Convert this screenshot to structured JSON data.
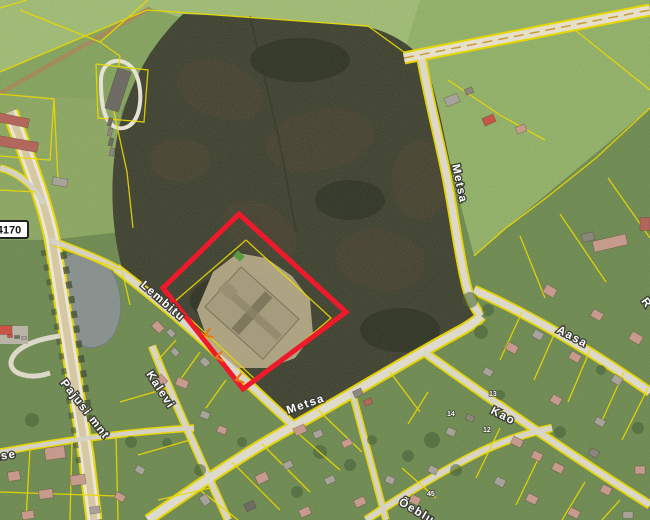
{
  "map": {
    "parcel_color": "#ecd800",
    "highlight": {
      "color": "#ee1a2b"
    },
    "road_badge": {
      "text": "4170"
    },
    "street_labels": [
      {
        "id": "lembitu",
        "text": "Lembitu"
      },
      {
        "id": "kalevi",
        "text": "Kalevi"
      },
      {
        "id": "metsa-south",
        "text": "Metsa"
      },
      {
        "id": "metsa-north",
        "text": "Metsa"
      },
      {
        "id": "aasa",
        "text": "Aasa"
      },
      {
        "id": "pajusi-mnt",
        "text": "Pajusi mnt"
      },
      {
        "id": "kao",
        "text": "Kao"
      },
      {
        "id": "oeblu",
        "text": "Õeblu"
      },
      {
        "id": "kase",
        "text": "Kase"
      },
      {
        "id": "r-partial",
        "text": "R"
      }
    ],
    "house_numbers": [
      {
        "text": "14"
      },
      {
        "text": "13"
      },
      {
        "text": "12"
      },
      {
        "text": "45"
      }
    ],
    "house_colors": [
      "#c79a8e",
      "#b3675c",
      "#a7a39a",
      "#6e6c64",
      "#c75548",
      "#8b877d"
    ],
    "houses": [
      [
        118,
        90,
        14,
        42,
        18,
        3
      ],
      [
        12,
        120,
        34,
        9,
        12,
        1
      ],
      [
        18,
        144,
        40,
        10,
        10,
        1
      ],
      [
        60,
        182,
        15,
        8,
        10,
        2
      ],
      [
        4,
        330,
        16,
        9,
        0,
        4
      ],
      [
        452,
        100,
        14,
        9,
        -22,
        2
      ],
      [
        469,
        91,
        8,
        6,
        -22,
        5
      ],
      [
        489,
        120,
        12,
        8,
        -24,
        4
      ],
      [
        521,
        129,
        10,
        7,
        -24,
        0
      ],
      [
        610,
        243,
        34,
        11,
        -13,
        0
      ],
      [
        645,
        224,
        10,
        13,
        0,
        1
      ],
      [
        588,
        237,
        12,
        8,
        -13,
        5
      ],
      [
        550,
        291,
        12,
        9,
        30,
        0
      ],
      [
        597,
        315,
        11,
        8,
        30,
        0
      ],
      [
        636,
        338,
        12,
        9,
        30,
        0
      ],
      [
        538,
        335,
        10,
        8,
        30,
        2
      ],
      [
        575,
        357,
        11,
        8,
        30,
        0
      ],
      [
        617,
        380,
        10,
        8,
        30,
        2
      ],
      [
        512,
        348,
        11,
        8,
        28,
        0
      ],
      [
        488,
        372,
        9,
        7,
        28,
        2
      ],
      [
        556,
        400,
        10,
        8,
        28,
        0
      ],
      [
        600,
        422,
        10,
        7,
        28,
        2
      ],
      [
        517,
        442,
        11,
        8,
        27,
        0
      ],
      [
        537,
        456,
        10,
        8,
        27,
        0
      ],
      [
        558,
        468,
        11,
        8,
        27,
        0
      ],
      [
        500,
        482,
        10,
        8,
        27,
        2
      ],
      [
        532,
        499,
        11,
        8,
        27,
        0
      ],
      [
        574,
        513,
        11,
        8,
        27,
        0
      ],
      [
        606,
        490,
        10,
        8,
        27,
        0
      ],
      [
        640,
        470,
        10,
        8,
        0,
        0
      ],
      [
        628,
        515,
        10,
        7,
        0,
        2
      ],
      [
        594,
        453,
        9,
        7,
        27,
        5
      ],
      [
        451,
        432,
        9,
        7,
        25,
        2
      ],
      [
        470,
        418,
        8,
        6,
        25,
        5
      ],
      [
        433,
        470,
        9,
        7,
        25,
        2
      ],
      [
        415,
        500,
        10,
        8,
        25,
        0
      ],
      [
        390,
        480,
        9,
        7,
        25,
        2
      ],
      [
        358,
        393,
        9,
        7,
        -25,
        5
      ],
      [
        368,
        402,
        8,
        6,
        -25,
        1
      ],
      [
        300,
        430,
        12,
        8,
        -25,
        0
      ],
      [
        318,
        434,
        9,
        7,
        -25,
        2
      ],
      [
        347,
        443,
        10,
        7,
        -25,
        0
      ],
      [
        262,
        478,
        12,
        9,
        -25,
        0
      ],
      [
        288,
        465,
        9,
        7,
        -25,
        2
      ],
      [
        330,
        480,
        10,
        7,
        -25,
        2
      ],
      [
        360,
        502,
        11,
        8,
        -25,
        0
      ],
      [
        250,
        506,
        10,
        8,
        -25,
        3
      ],
      [
        305,
        512,
        11,
        8,
        -25,
        0
      ],
      [
        205,
        500,
        10,
        8,
        55,
        2
      ],
      [
        182,
        383,
        12,
        8,
        22,
        0
      ],
      [
        205,
        415,
        9,
        7,
        22,
        2
      ],
      [
        222,
        430,
        9,
        7,
        22,
        0
      ],
      [
        158,
        327,
        11,
        8,
        46,
        0
      ],
      [
        171,
        333,
        8,
        6,
        46,
        2
      ],
      [
        175,
        352,
        8,
        6,
        46,
        2
      ],
      [
        162,
        380,
        10,
        7,
        46,
        0
      ],
      [
        205,
        362,
        9,
        7,
        46,
        2
      ],
      [
        55,
        453,
        20,
        12,
        -8,
        0
      ],
      [
        78,
        480,
        15,
        10,
        -8,
        0
      ],
      [
        46,
        494,
        14,
        9,
        -8,
        0
      ],
      [
        14,
        476,
        12,
        9,
        -8,
        0
      ],
      [
        28,
        515,
        12,
        8,
        -8,
        0
      ],
      [
        95,
        510,
        10,
        7,
        -8,
        2
      ],
      [
        140,
        470,
        9,
        7,
        30,
        2
      ],
      [
        120,
        497,
        10,
        7,
        30,
        0
      ],
      [
        110,
        122,
        4,
        8,
        15,
        3
      ],
      [
        110,
        132,
        4,
        8,
        15,
        5
      ],
      [
        111,
        142,
        4,
        8,
        15,
        3
      ],
      [
        112,
        152,
        4,
        8,
        15,
        5
      ],
      [
        10,
        336,
        5,
        3,
        0,
        4
      ],
      [
        17,
        337,
        5,
        3,
        0,
        3
      ],
      [
        24,
        338,
        5,
        3,
        0,
        2
      ]
    ]
  }
}
